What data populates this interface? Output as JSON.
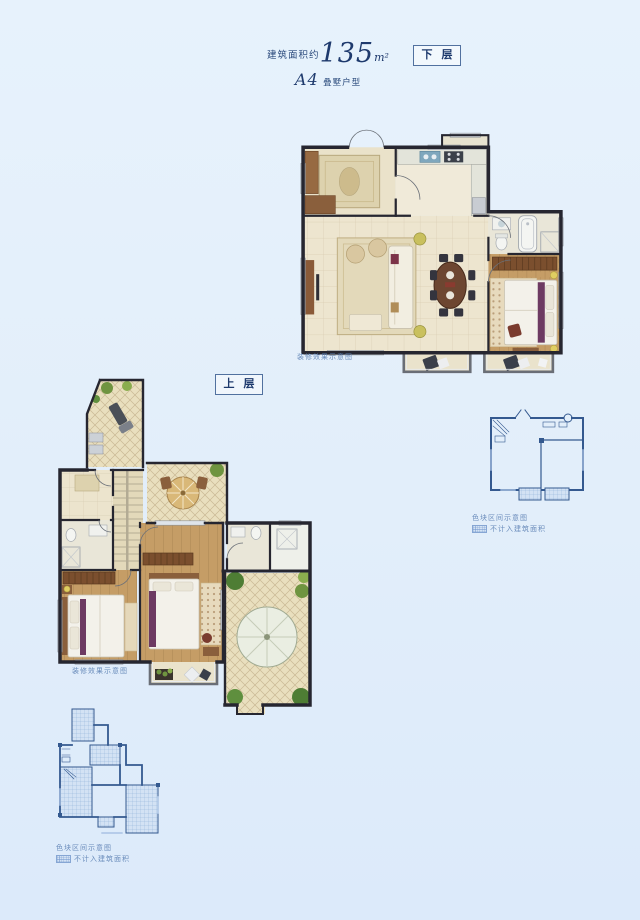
{
  "header": {
    "area_prefix": "建筑面积约",
    "area_value": "135",
    "area_unit": "m²",
    "unit_code": "A4",
    "unit_suffix": "叠墅户型"
  },
  "floor_labels": {
    "lower": "下 层",
    "upper": "上 层"
  },
  "captions": {
    "render_note": "装修效果示意图",
    "schematic_note": "色块区间示意图",
    "legend_not_counted": "不计入建筑面积"
  },
  "colors": {
    "background": "#e2eefa",
    "title_text": "#1e3a6d",
    "caption_text": "#5d81b4",
    "wall": "#262630",
    "floor_beige": "#ece4cd",
    "wood_floor": "#c59d66",
    "terrace_tile": "#e9dfbe",
    "schematic_line": "#34598f"
  }
}
